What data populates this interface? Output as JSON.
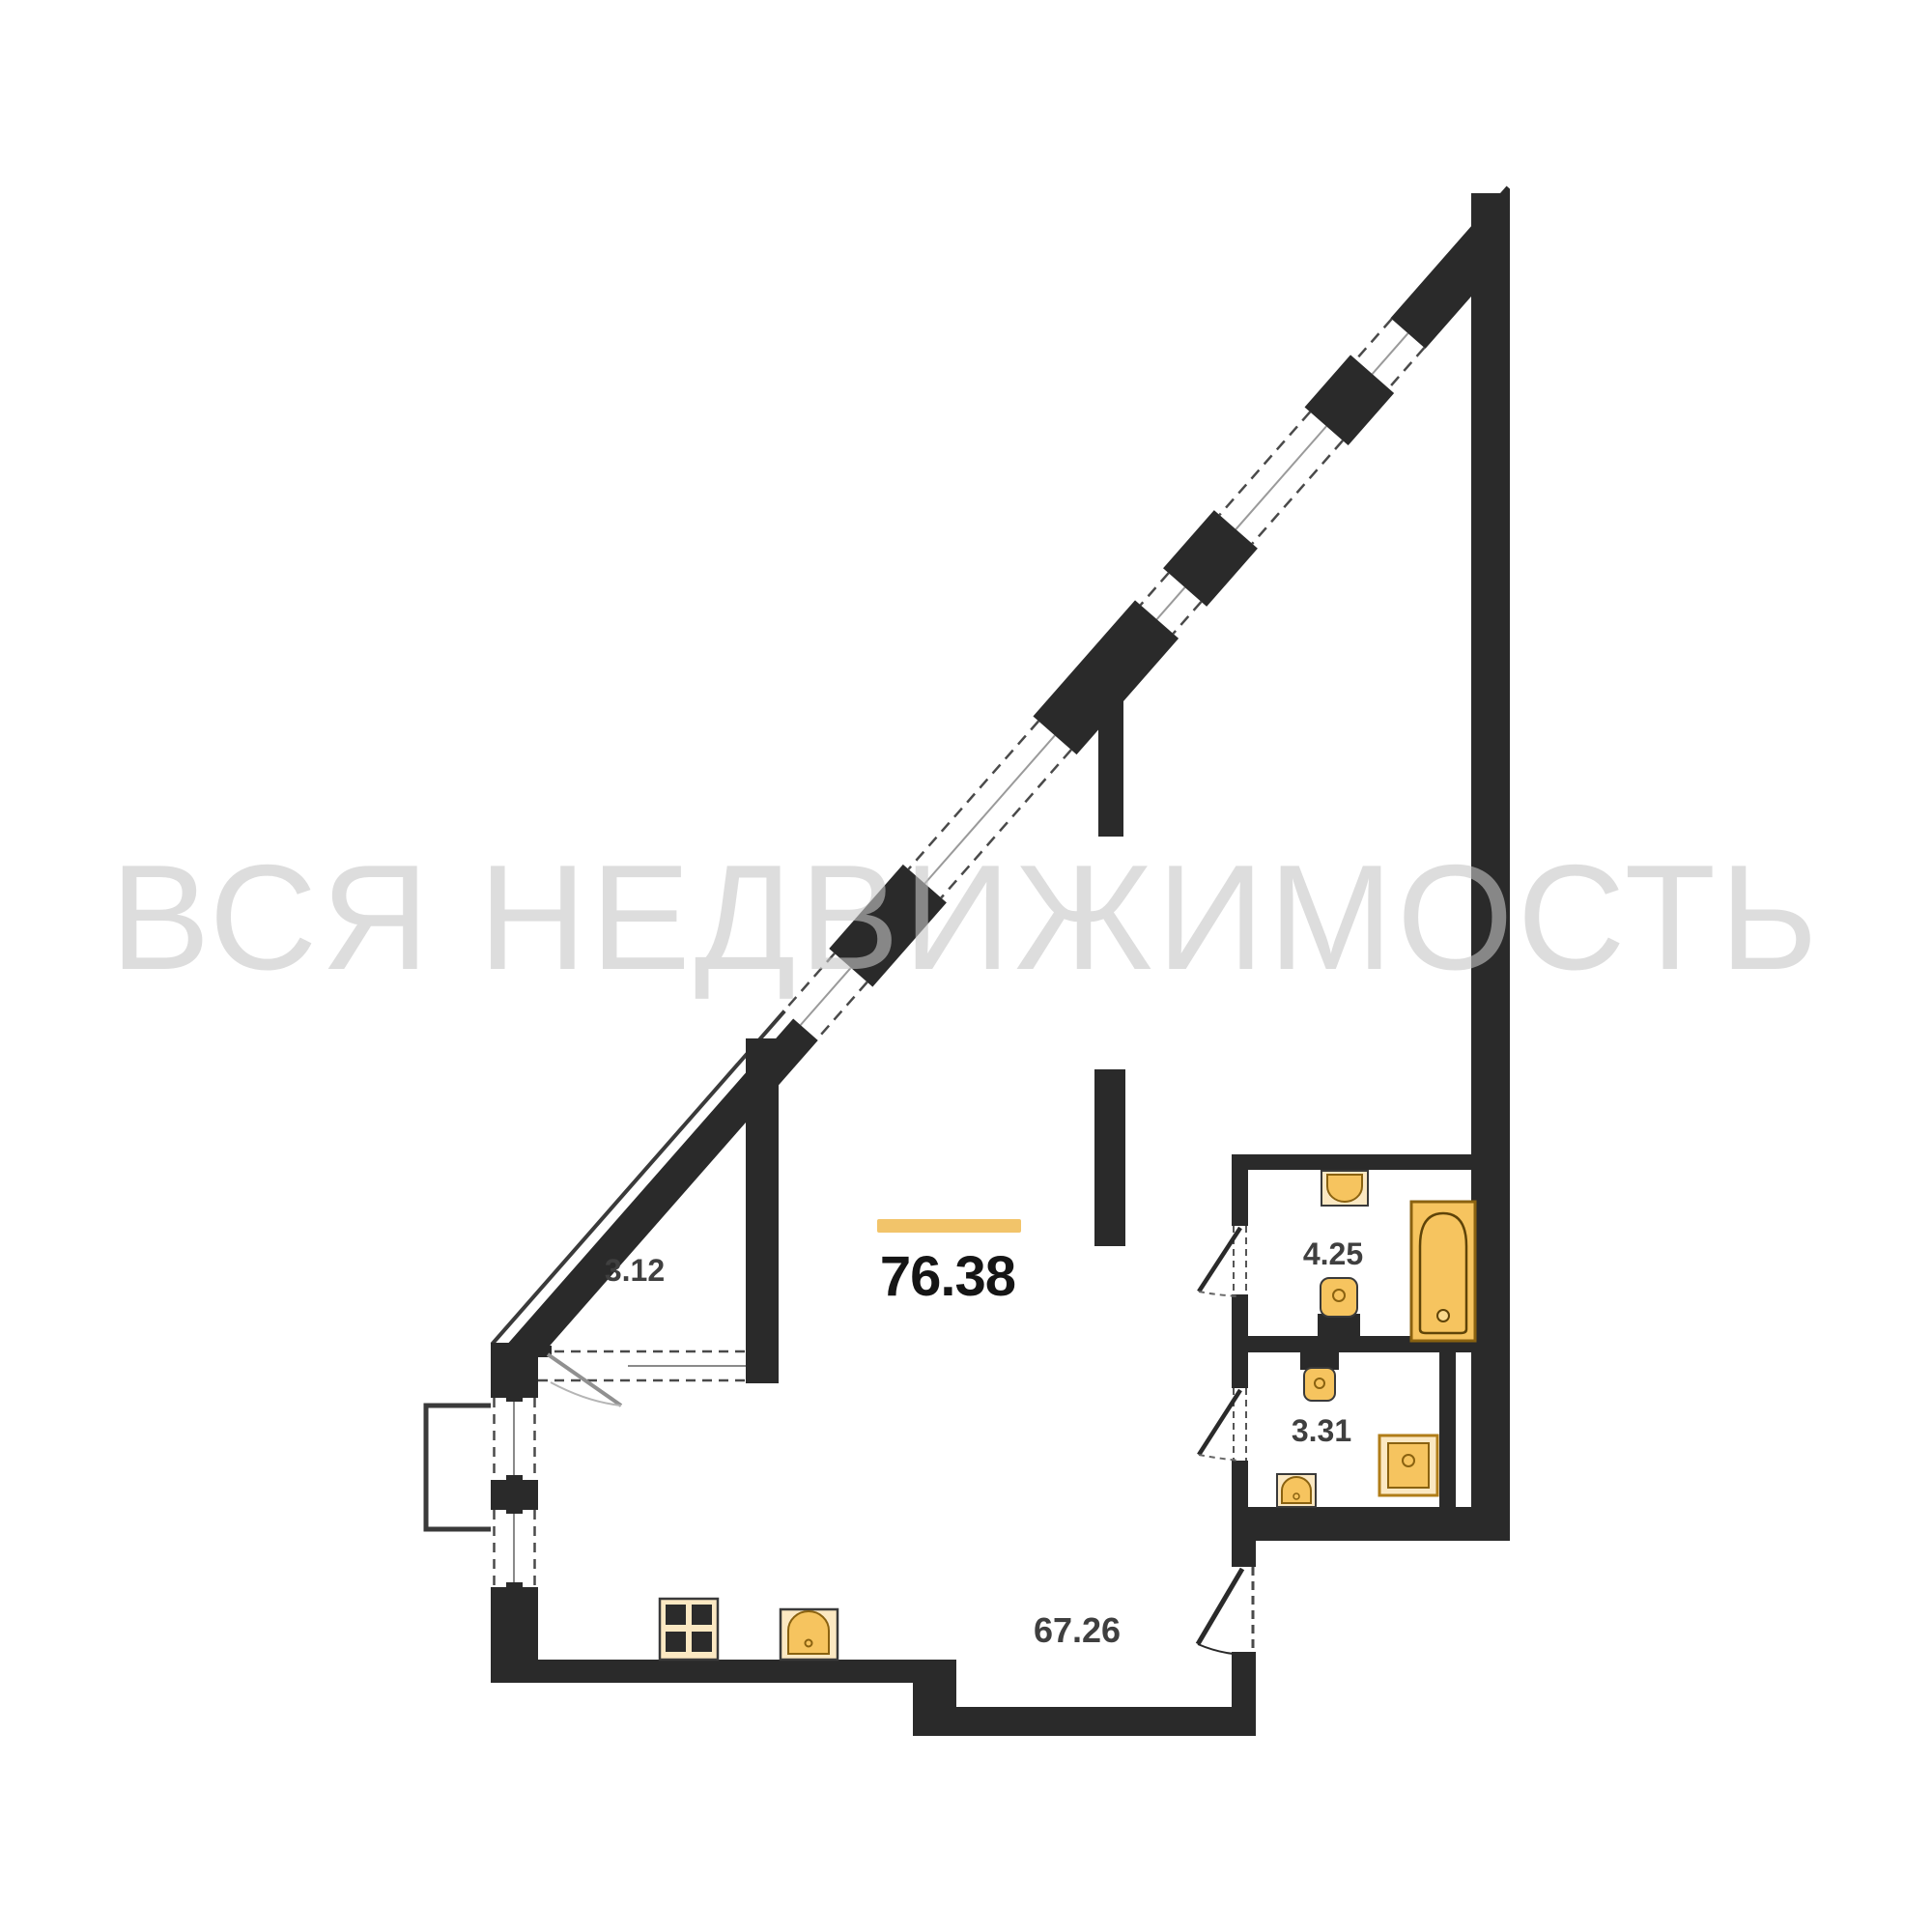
{
  "watermark": {
    "text": "ВСЯ НЕДВИЖИМОСТЬ"
  },
  "plan": {
    "total_area": "76.38",
    "rooms": {
      "loggia": "3.12",
      "bathroom": "4.25",
      "wc": "3.31",
      "living_kitchen": "67.26"
    },
    "colors": {
      "wall": "#2a2a2a",
      "fixture_fill": "#f6c45f",
      "fixture_frame": "#fbe8c2",
      "fixture_outline": "#8a6210",
      "fixture_border": "#b07d18",
      "accent_bar": "#f2c46a",
      "room_label": "#3f3f3f",
      "total_label": "#151515",
      "watermark_gray": "#c8c8c8"
    }
  }
}
